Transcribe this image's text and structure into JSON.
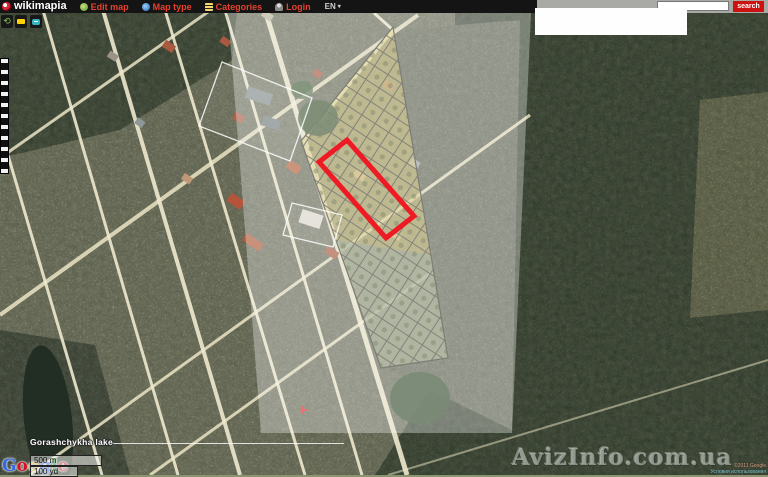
{
  "toolbar": {
    "logo": "wikimapia",
    "menu": [
      {
        "label": "Edit map",
        "icon": "edit-map-icon"
      },
      {
        "label": "Map type",
        "icon": "map-type-icon"
      },
      {
        "label": "Categories",
        "icon": "categories-icon"
      },
      {
        "label": "Login",
        "icon": "login-icon"
      }
    ],
    "language": "EN",
    "language_caret": "▾",
    "search": {
      "placeholder": "",
      "value": "",
      "button_label": "search",
      "button_color": "#cc1111"
    }
  },
  "map": {
    "lake_label": "Gorashchykha lake",
    "watermark": "AvizInfo.com.ua",
    "google_letters": [
      "G",
      "o",
      "o",
      "g",
      "l",
      "e"
    ],
    "scale": {
      "metric": "500 m",
      "imperial": "100 yd"
    },
    "attribution_line1": "©2011 Google",
    "attribution_line2": "Условия использования",
    "selection_outline_color": "#ee1b24",
    "overlay": "semi-transparent white highlight band"
  }
}
